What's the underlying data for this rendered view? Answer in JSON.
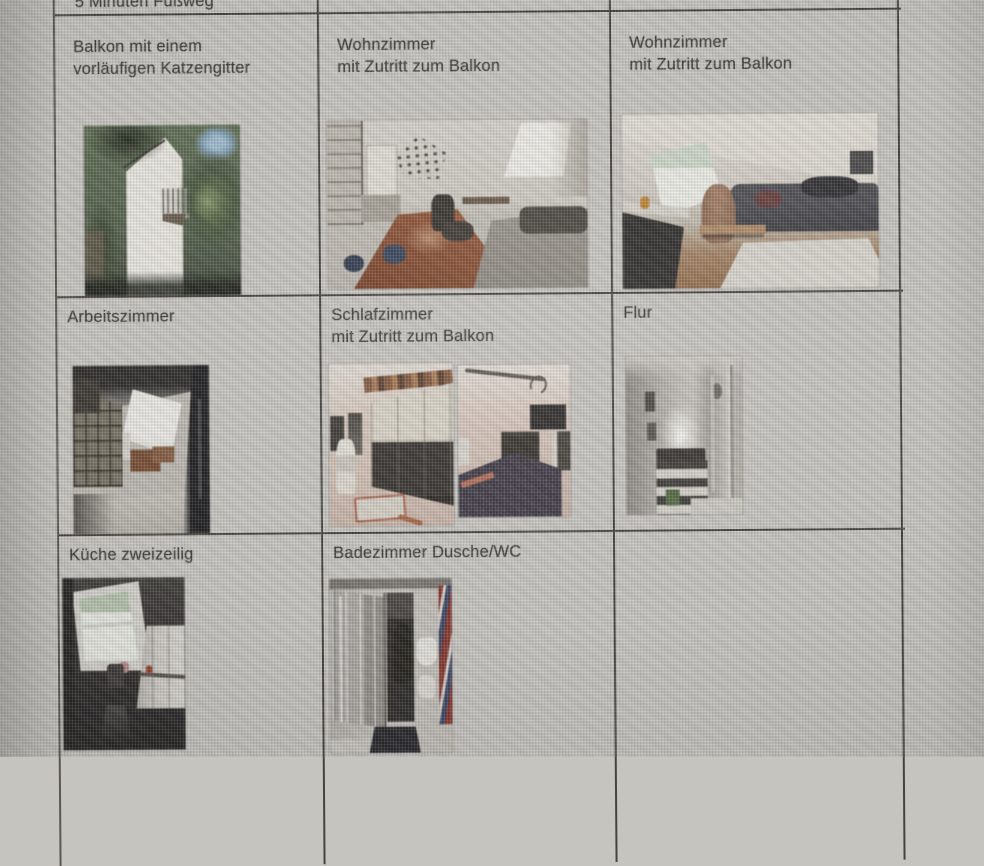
{
  "document": {
    "partial_top_row": {
      "col1_label": "5 Minuten Fußweg",
      "col2_label": "",
      "col3_label": ""
    },
    "rows": [
      {
        "cells": [
          {
            "label": "Balkon mit einem\nvorläufigen Katzengitter"
          },
          {
            "label": "Wohnzimmer\nmit Zutritt zum Balkon"
          },
          {
            "label": "Wohnzimmer\nmit Zutritt zum Balkon"
          }
        ]
      },
      {
        "cells": [
          {
            "label": "Arbeitszimmer"
          },
          {
            "label": "Schlafzimmer\nmit Zutritt zum Balkon"
          },
          {
            "label": "Flur"
          }
        ]
      },
      {
        "cells": [
          {
            "label": "Küche zweizeilig"
          },
          {
            "label": "Badezimmer Dusche/WC"
          },
          {
            "label": ""
          }
        ]
      }
    ]
  },
  "colors": {
    "page_background": "#c6c4bf",
    "table_border": "#45433e",
    "text": "#42413d"
  }
}
